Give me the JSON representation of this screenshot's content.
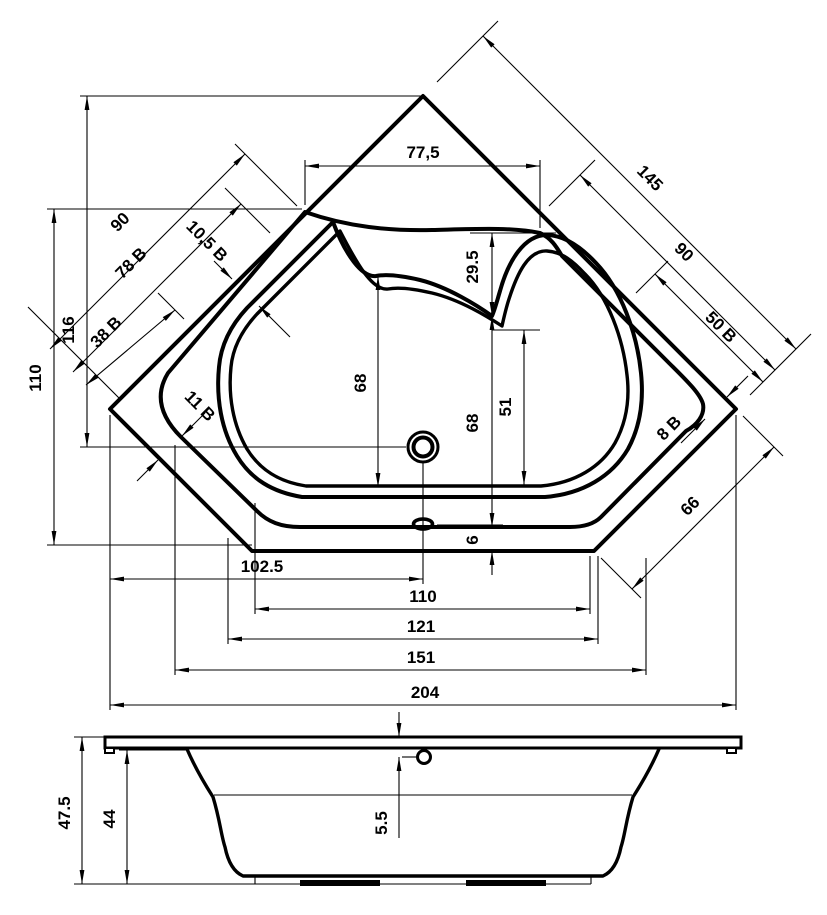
{
  "title": "Corner bathtub technical drawing",
  "accent_color": "#000000",
  "background_color": "#ffffff",
  "views": {
    "plan": "top view",
    "side": "front elevation"
  },
  "dims": {
    "top_span": "77,5",
    "right_edge_total": "145",
    "left_edge_90": "90",
    "left_edge_78": "78 B",
    "left_gap_10_5": "10,5 B",
    "left_edge_38": "38 B",
    "left_gap_11": "11 B",
    "right_edge_90": "90",
    "right_edge_50": "50 B",
    "right_gap_8": "8 B",
    "lower_right_edge": "66",
    "apex_to_drain": "116",
    "neck_to_bottom": "110",
    "well_left_depth": "68",
    "lobe_to_saddle": "29.5",
    "saddle_to_base": "68",
    "seat_to_bottom": "51",
    "base_offset": "6",
    "drain_offset_x": "102.5",
    "well_width": "110",
    "shell_width": "121",
    "inner_width": "151",
    "overall_width": "204",
    "total_height": "47.5",
    "shell_height": "44",
    "overflow_drop": "5.5"
  }
}
